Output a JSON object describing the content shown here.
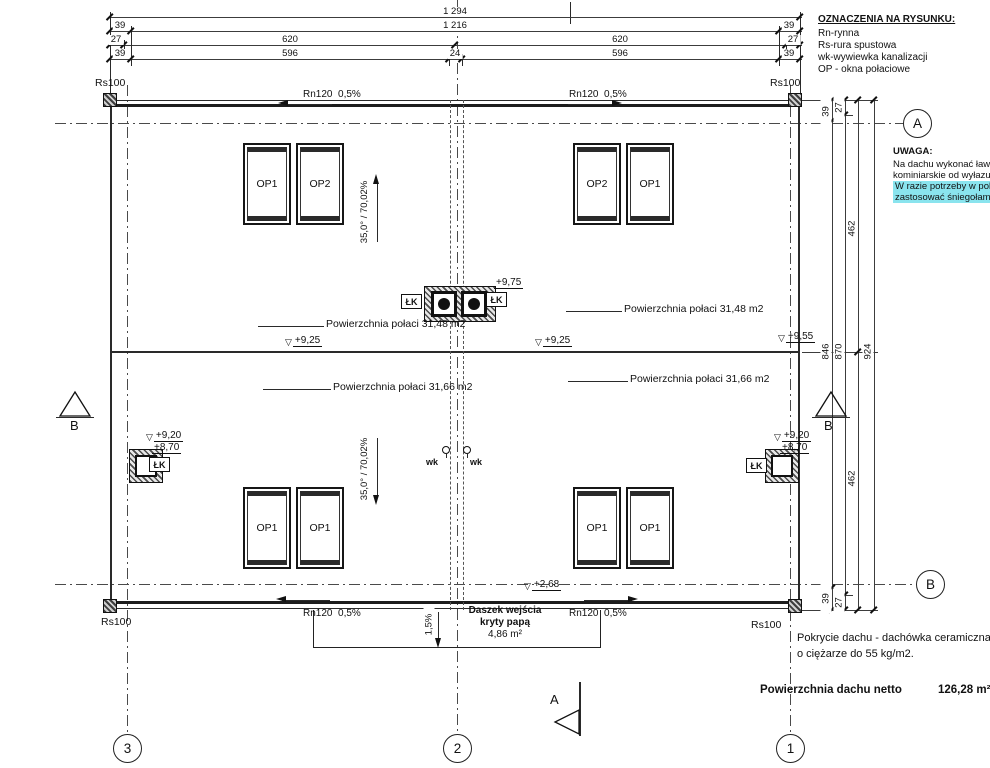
{
  "legend": {
    "title": "OZNACZENIA NA RYSUNKU:",
    "items": [
      "Rn-rynna",
      "Rs-rura spustowa",
      "wk-wywiewka kanalizacji",
      "OP - okna połaciowe"
    ]
  },
  "note": {
    "title": "UWAGA:",
    "lines": [
      "Na dachu wykonać ławy i s",
      "kominiarskie od wyłazu da"
    ],
    "highlighted": [
      "W razie potrzeby w pokryc",
      "zastosować śniegołamacz"
    ],
    "highlight_color": "#8ae4ee"
  },
  "top_dims": {
    "total": "1 294",
    "row2": [
      "39",
      "1 216",
      "39"
    ],
    "row3": [
      "27",
      "620",
      "620",
      "27"
    ],
    "row4": [
      "39",
      "596",
      "24",
      "596",
      "39"
    ]
  },
  "right_dims": {
    "c1": [
      "39",
      "846",
      "39"
    ],
    "c2": [
      "27",
      "870",
      "27"
    ],
    "c3": [
      "462",
      "462"
    ],
    "c4": [
      "924"
    ]
  },
  "labels": {
    "gutter": "Rn120  0,5%",
    "downpipe": "Rs100",
    "chimney": "ŁK",
    "vent": "wk",
    "slope": "35,0° / 70,02%",
    "canopy_slope": "1,5%"
  },
  "areas": {
    "upper": "Powierzchnia połaci 31,48 m2",
    "lower": "Powierzchnia połaci 31,66 m2"
  },
  "elevations": {
    "ridge": "+9,25",
    "ridge_right": "+9,55",
    "chimney_top": "+9,75",
    "chimney_cap": "+9,20",
    "chimney_base": "+8,70",
    "canopy": "+2,68"
  },
  "canopy": {
    "name_line1": "Daszek wejścia",
    "name_line2": "kryty papą",
    "area": "4,86 m²"
  },
  "windows": {
    "tl": [
      "OP1",
      "OP2"
    ],
    "tr": [
      "OP2",
      "OP1"
    ],
    "bl": [
      "OP1",
      "OP1"
    ],
    "br": [
      "OP1",
      "OP1"
    ]
  },
  "grid_axes": [
    "3",
    "2",
    "1"
  ],
  "section_markers": {
    "a": "A",
    "b": "B"
  },
  "footer": {
    "covering_line1": "Pokrycie dachu - dachówka ceramiczna",
    "covering_line2": "o ciężarze do  55 kg/m2.",
    "net_area_label": "Powierzchnia dachu netto",
    "net_area_value": "126,28 m²"
  },
  "icons": {
    "elevation_triangle": "▽"
  },
  "colors": {
    "line": "#1a1a1a",
    "highlight": "#8ae4ee"
  }
}
